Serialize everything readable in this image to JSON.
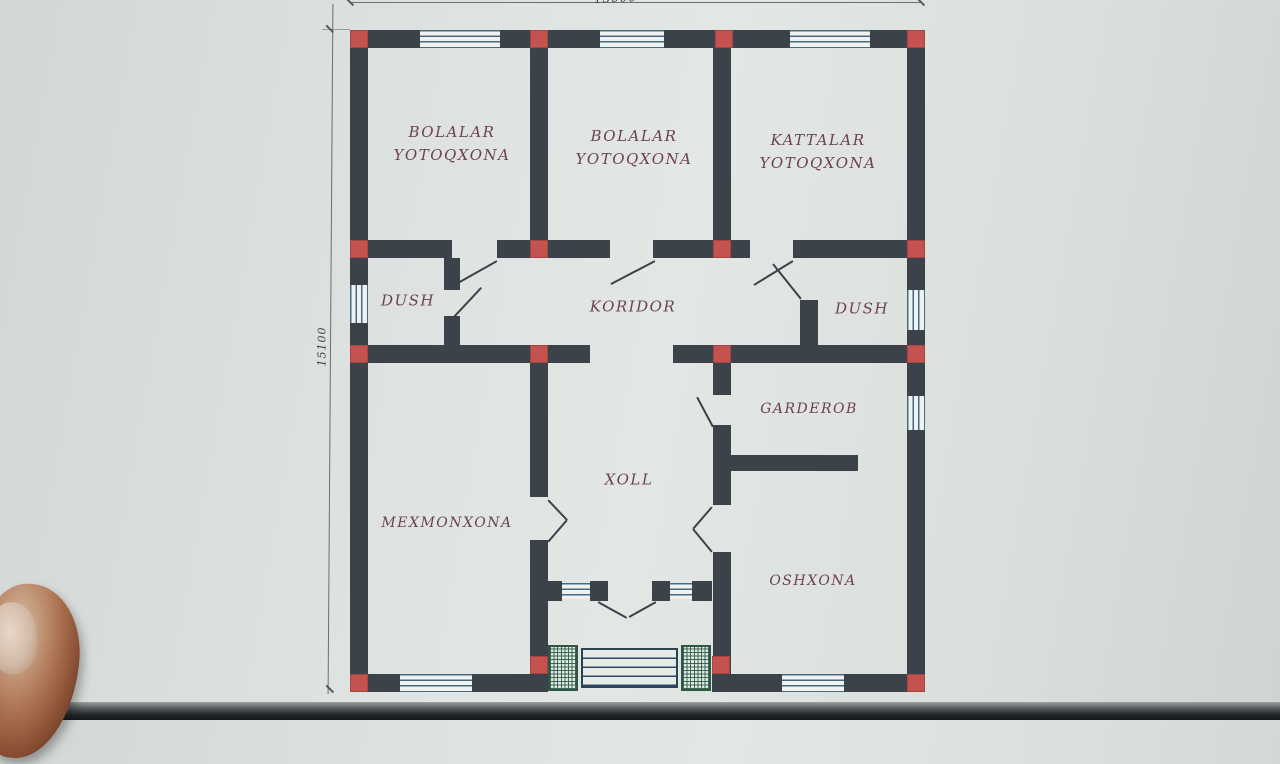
{
  "plan": {
    "rooms": [
      {
        "key": "bolalar-yotoqxona-1",
        "label": "BOLALAR YOTOQXONA"
      },
      {
        "key": "bolalar-yotoqxona-2",
        "label": "BOLALAR YOTOQXONA"
      },
      {
        "key": "kattalar-yotoqxona",
        "label": "KATTALAR YOTOQXONA"
      },
      {
        "key": "dush-left",
        "label": "DUSH"
      },
      {
        "key": "koridor",
        "label": "KORIDOR"
      },
      {
        "key": "dush-right",
        "label": "DUSH"
      },
      {
        "key": "garderob",
        "label": "GARDEROB"
      },
      {
        "key": "xoll",
        "label": "XOLL"
      },
      {
        "key": "mexmonxona",
        "label": "MEXMONXONA"
      },
      {
        "key": "oshxona",
        "label": "OSHXONA"
      }
    ],
    "dimensions": {
      "left": "15100",
      "top": "15000"
    },
    "colors": {
      "wall": "#3b424a",
      "column": "#c4524f",
      "room_label": "#6d4252",
      "paper": "#dde2e0",
      "window_line": "#4a6880",
      "porch_hatch": "#2e5644"
    }
  }
}
